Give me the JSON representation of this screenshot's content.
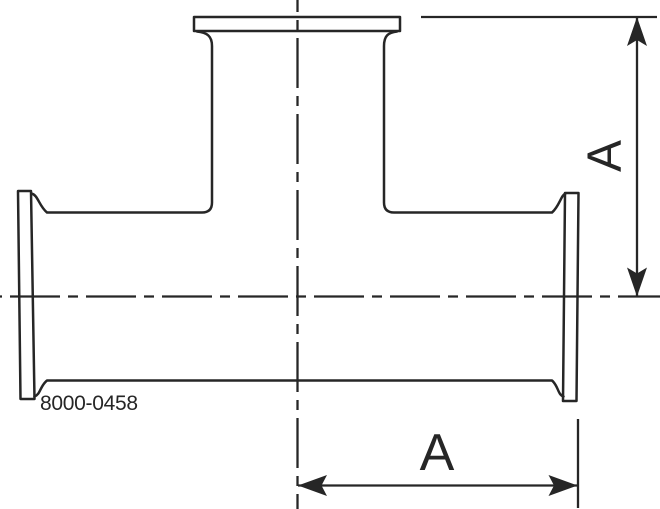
{
  "drawing": {
    "part_number": "8000-0458",
    "dimension_labels": {
      "branch_height": "A",
      "run_half_length": "A"
    },
    "colors": {
      "line": "#262626",
      "background": "#ffffff"
    }
  }
}
